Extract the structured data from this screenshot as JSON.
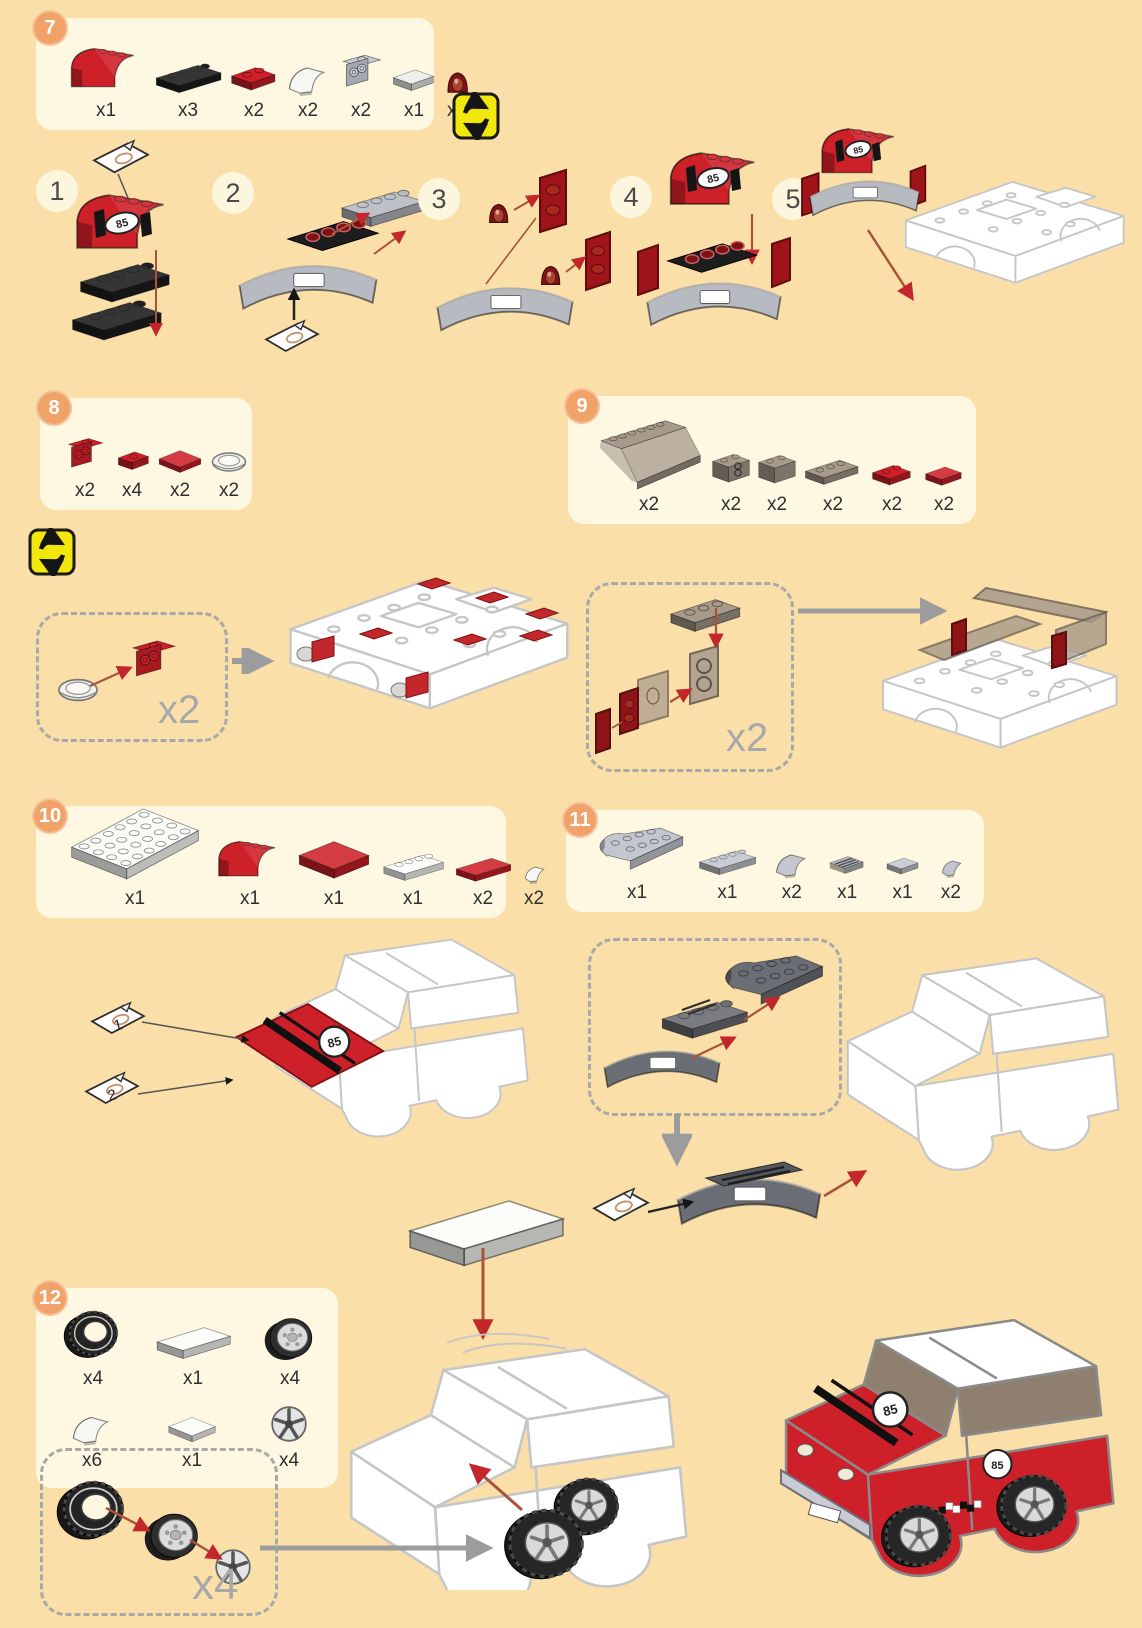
{
  "page": {
    "bg": "#FBDFA8",
    "panel_bg": "#FEF8E2"
  },
  "colors": {
    "red": "#CE2029",
    "dark_red": "#8A1A1C",
    "black": "#1F1F1F",
    "gray_part": "#C9CCD4",
    "dark_gray_part": "#6B6E74",
    "smoke": "#A79A8B",
    "accent_orange": "#F0A269",
    "arrow_red": "#C3272B",
    "arrow_gray": "#9C9C9C",
    "rotate_yellow": "#F2E70C",
    "line_art": "#C6C6C6"
  },
  "step7": {
    "number": "7",
    "parts": [
      {
        "name": "red-curved-brick",
        "qty": "x1"
      },
      {
        "name": "black-1x4-plate",
        "qty": "x3"
      },
      {
        "name": "red-1x2-plate",
        "qty": "x2"
      },
      {
        "name": "white-curved-slope",
        "qty": "x2"
      },
      {
        "name": "gray-bracket",
        "qty": "x2"
      },
      {
        "name": "white-1x2-tile",
        "qty": "x1"
      },
      {
        "name": "dark-red-mudguard",
        "qty": "x2"
      }
    ]
  },
  "substeps": {
    "s1": "1",
    "s2": "2",
    "s3": "3",
    "s4": "4",
    "s5": "5"
  },
  "step8": {
    "number": "8",
    "multiplier": "x2",
    "parts": [
      {
        "name": "red-bracket",
        "qty": "x2"
      },
      {
        "name": "red-1x1-plate",
        "qty": "x4"
      },
      {
        "name": "red-2x2-tile",
        "qty": "x2"
      },
      {
        "name": "clear-dish",
        "qty": "x2"
      }
    ]
  },
  "step9": {
    "number": "9",
    "multiplier": "x2",
    "parts": [
      {
        "name": "smoke-windscreen",
        "qty": "x2"
      },
      {
        "name": "smoke-1x2-brick-headlight",
        "qty": "x2"
      },
      {
        "name": "smoke-1x2-brick",
        "qty": "x2"
      },
      {
        "name": "smoke-1x3-plate",
        "qty": "x2"
      },
      {
        "name": "red-1x2-plate",
        "qty": "x2"
      },
      {
        "name": "red-1x2-tile",
        "qty": "x2"
      }
    ]
  },
  "step10": {
    "number": "10",
    "sticker_sheet_1": "1",
    "sticker_sheet_2": "2",
    "parts": [
      {
        "name": "white-4x6-plate",
        "qty": "x1"
      },
      {
        "name": "red-curved-brick",
        "qty": "x1"
      },
      {
        "name": "red-4x4-tile",
        "qty": "x1"
      },
      {
        "name": "white-1x4-plate",
        "qty": "x1"
      },
      {
        "name": "red-1x4-tile",
        "qty": "x2"
      },
      {
        "name": "white-corner-slope",
        "qty": "x2"
      }
    ]
  },
  "step11": {
    "number": "11",
    "parts": [
      {
        "name": "gray-2x4-rounded-plate",
        "qty": "x1"
      },
      {
        "name": "gray-1x4-plate",
        "qty": "x1"
      },
      {
        "name": "gray-curved-slope",
        "qty": "x2"
      },
      {
        "name": "gray-grille-tile",
        "qty": "x1"
      },
      {
        "name": "gray-1x2-tile",
        "qty": "x1"
      },
      {
        "name": "gray-corner-slope",
        "qty": "x2"
      }
    ]
  },
  "step12": {
    "number": "12",
    "multiplier": "x4",
    "row1": [
      {
        "name": "tire",
        "qty": "x4"
      },
      {
        "name": "white-2x4-tile",
        "qty": "x1"
      },
      {
        "name": "wheel-rim",
        "qty": "x4"
      }
    ],
    "row2": [
      {
        "name": "white-2x2-slope",
        "qty": "x6"
      },
      {
        "name": "white-2x2-tile",
        "qty": "x1"
      },
      {
        "name": "wheel-cover",
        "qty": "x4"
      }
    ]
  },
  "decals": {
    "race_number": "85"
  }
}
